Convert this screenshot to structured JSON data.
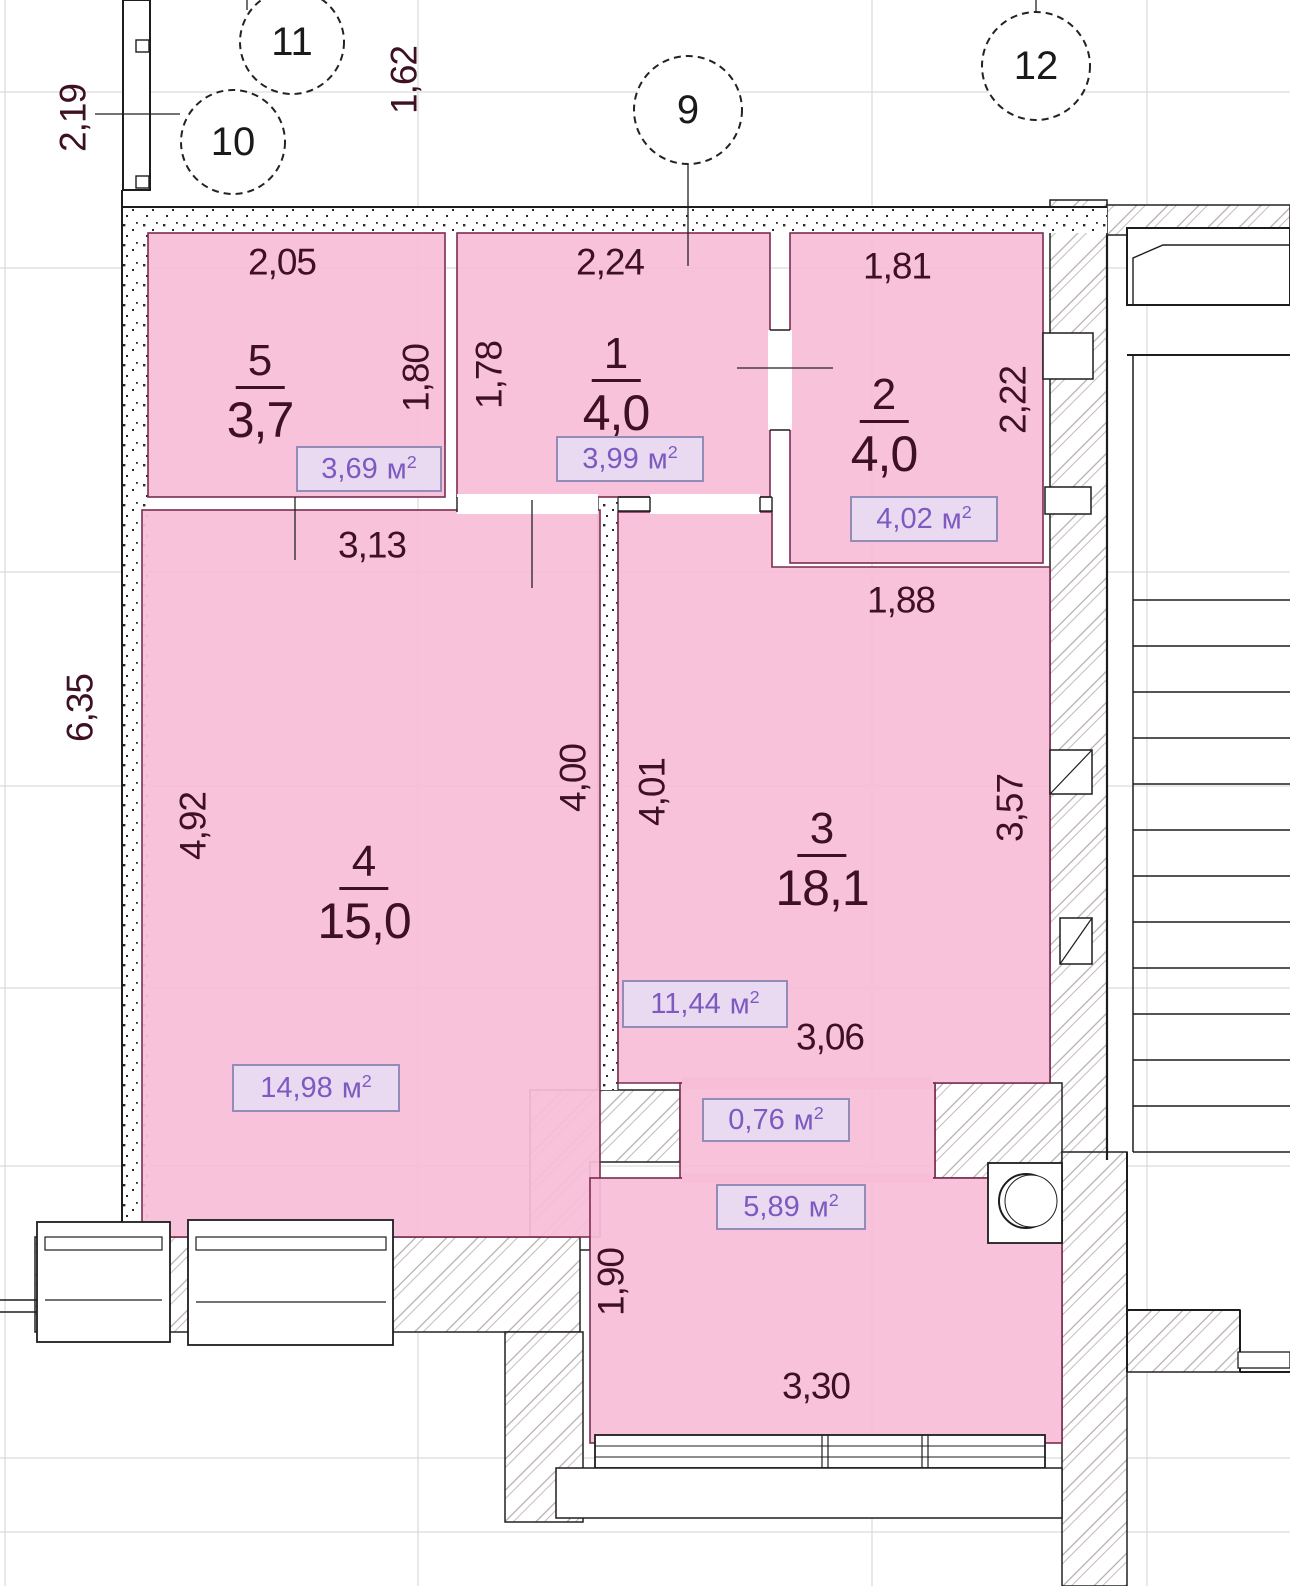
{
  "colors": {
    "room_fill": "#f8bdd7",
    "room_border": "#7a2c50",
    "area_box_fill": "#e9daf2",
    "area_box_border": "#948cb8",
    "area_text": "#7d59c0",
    "dim_text": "#3d1024",
    "wall_line": "#1d1d1d"
  },
  "unit": {
    "base": "м",
    "sup": "2"
  },
  "axis_markers": {
    "m9": "9",
    "m10": "10",
    "m11": "11",
    "m12": "12"
  },
  "rooms": {
    "r5": {
      "num": "5",
      "size": "3,7",
      "area": "3,69"
    },
    "r1": {
      "num": "1",
      "size": "4,0",
      "area": "3,99"
    },
    "r2": {
      "num": "2",
      "size": "4,0",
      "area": "4,02"
    },
    "r4": {
      "num": "4",
      "size": "15,0",
      "area": "14,98"
    },
    "r3": {
      "num": "3",
      "size": "18,1",
      "area": "11,44"
    },
    "passage": {
      "area": "0,76"
    },
    "lower": {
      "area": "5,89"
    }
  },
  "dims": {
    "v2_19": "2,19",
    "v1_62": "1,62",
    "h2_05": "2,05",
    "h2_24": "2,24",
    "h1_81": "1,81",
    "v1_80": "1,80",
    "v1_78": "1,78",
    "v2_22": "2,22",
    "h3_13": "3,13",
    "h1_88": "1,88",
    "v6_35": "6,35",
    "v4_92": "4,92",
    "v4_00": "4,00",
    "v4_01": "4,01",
    "v3_57": "3,57",
    "h3_06": "3,06",
    "v1_90": "1,90",
    "h3_30": "3,30"
  }
}
